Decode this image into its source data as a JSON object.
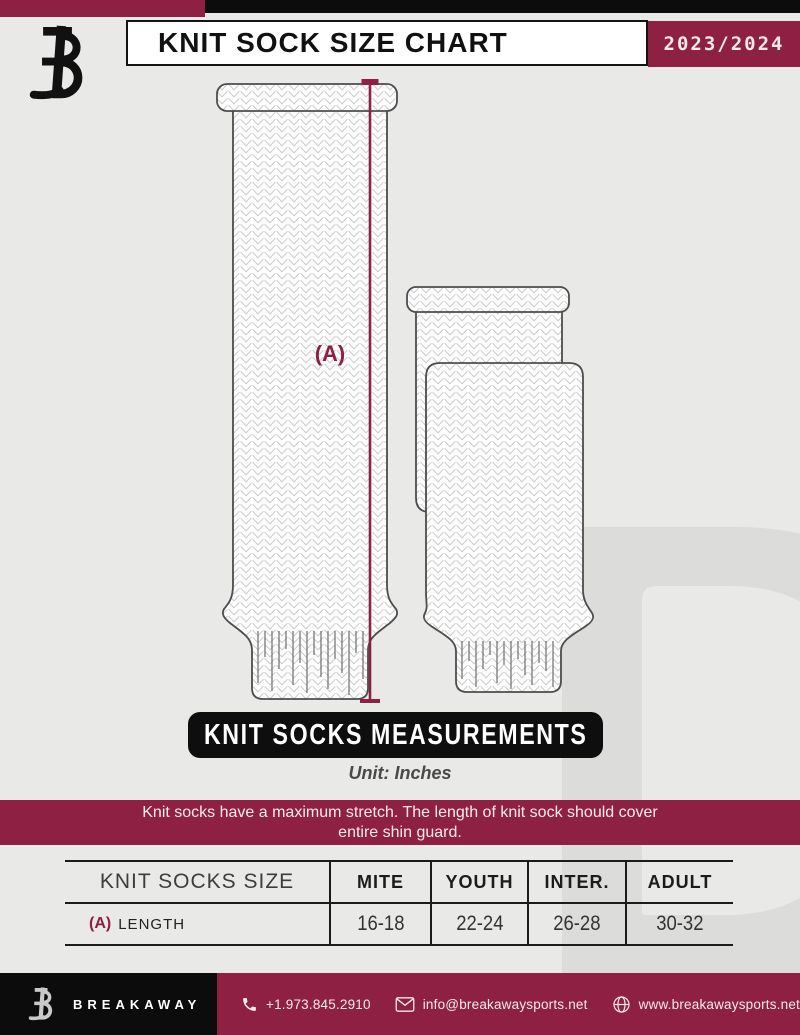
{
  "header": {
    "title": "KNIT SOCK SIZE CHART",
    "season": "2023/2024"
  },
  "diagram": {
    "measurement_label": "(A)",
    "banner_label": "KNIT SOCKS MEASUREMENTS",
    "unit_label": "Unit: Inches",
    "note_line1": "Knit socks have a maximum stretch. The length of knit sock should cover",
    "note_line2": "entire shin guard."
  },
  "table": {
    "size_header": "KNIT SOCKS SIZE",
    "columns": [
      "MITE",
      "YOUTH",
      "INTER.",
      "ADULT"
    ],
    "row": {
      "label_prefix": "(A)",
      "label": "LENGTH",
      "values": [
        "16-18",
        "22-24",
        "26-28",
        "30-32"
      ]
    }
  },
  "footer": {
    "brand": "BREAKAWAY",
    "phone": "+1.973.845.2910",
    "email": "info@breakawaysports.net",
    "website": "www.breakawaysports.net"
  },
  "colors": {
    "maroon": "#8d2043",
    "black": "#0c0c0c",
    "background": "#e9e9e7",
    "watermark": "#dcdcda"
  }
}
